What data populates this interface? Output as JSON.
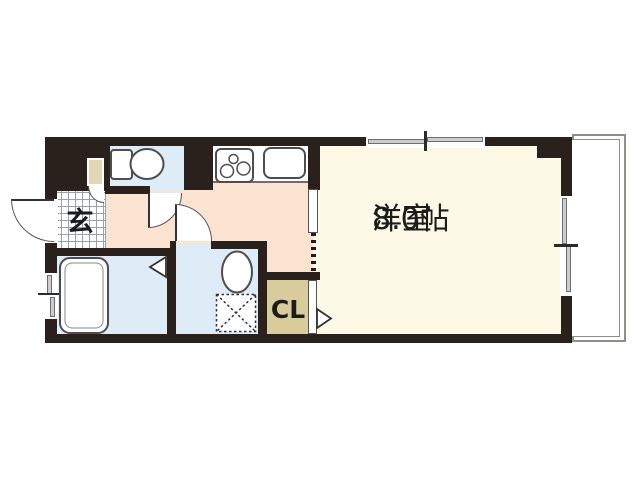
{
  "floor_plan": {
    "labels": {
      "genkan": "玄",
      "main_room_name": "洋室",
      "main_room_size": "8.0帖",
      "closet": "CL"
    },
    "colors": {
      "wall": "#2a211c",
      "room": "#fcfae7",
      "hall": "#fae4d1",
      "wet": "#ddecf7",
      "closet": "#d9cc9c",
      "cabinet": "#e3d8b6",
      "grid": "#99a0a6",
      "pane": "#cdcdcd",
      "line": "#4d4d4d",
      "text": "#1c1c1c"
    },
    "icons": [
      "toilet-icon",
      "bathtub-icon",
      "washbasin-icon",
      "washing-machine-pan-icon",
      "stove-icon",
      "kitchen-sink-icon",
      "entrance-door-icon",
      "toilet-door-icon",
      "washroom-door-icon",
      "sliding-door-icon",
      "closet-door-triangle-icon",
      "bathroom-folding-door-icon"
    ]
  }
}
